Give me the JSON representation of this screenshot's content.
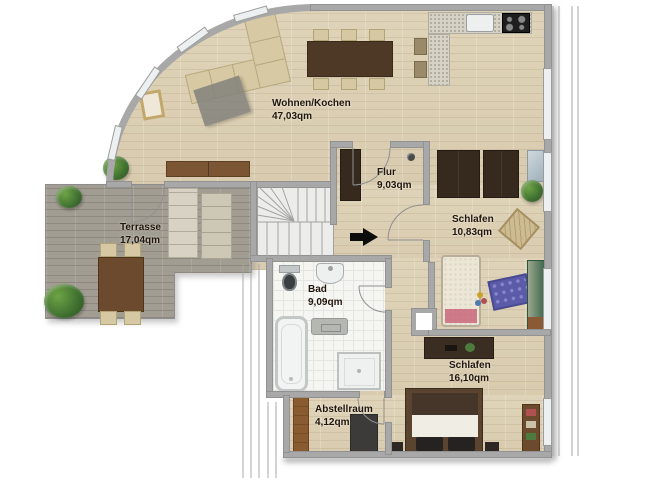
{
  "rooms": {
    "wohnen": {
      "label": "Wohnen/Kochen",
      "area": "47,03qm"
    },
    "flur": {
      "label": "Flur",
      "area": "9,03qm"
    },
    "schlafen1": {
      "label": "Schlafen",
      "area": "10,83qm"
    },
    "terrasse": {
      "label": "Terrasse",
      "area": "17,04qm"
    },
    "bad": {
      "label": "Bad",
      "area": "9,09qm"
    },
    "schlafen2": {
      "label": "Schlafen",
      "area": "16,10qm"
    },
    "abstellraum": {
      "label": "Abstellraum",
      "area": "4,12qm"
    }
  },
  "colors": {
    "wall": "#a8a8a8",
    "floor_wood": "#dbcfb4",
    "terrace_wood": "#a29d92",
    "bath_tile": "#f5f5f2",
    "label_text": "#20160a",
    "entry_arrow": "#0d0d0d",
    "dark_furniture": "#362a1f",
    "sofa_beige": "#d6c9a4"
  },
  "furniture": {
    "wohnen": [
      "corner-sofa",
      "rug",
      "picture-frame",
      "sideboard",
      "dining-table",
      "dining-chairs",
      "kitchen-counter",
      "kitchen-sink",
      "cooktop",
      "bar-stools",
      "plant"
    ],
    "terrasse": [
      "sun-loungers",
      "outdoor-table",
      "outdoor-chairs",
      "plants"
    ],
    "flur": [
      "wardrobe",
      "smoke-detector"
    ],
    "schlafen1": [
      "wardrobe",
      "mirror",
      "child-bed",
      "play-mat",
      "wicker-chair",
      "green-cabinet",
      "plant"
    ],
    "bad": [
      "toilet",
      "washbasin",
      "cabinet",
      "bathtub",
      "shower"
    ],
    "schlafen2": [
      "desk",
      "double-bed",
      "nightstands",
      "shelf"
    ],
    "abstellraum": [
      "wooden-door",
      "cabinet"
    ],
    "circulation": [
      "staircase",
      "entry-arrow"
    ]
  }
}
